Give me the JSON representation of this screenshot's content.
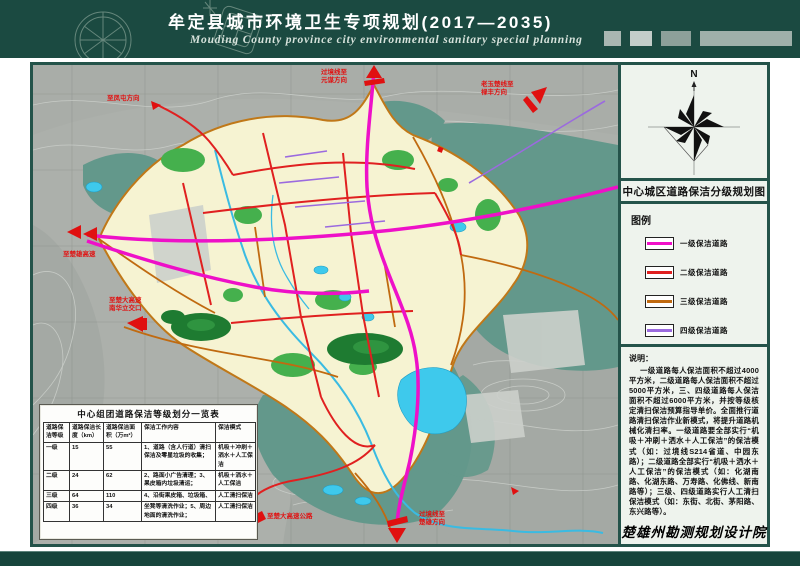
{
  "header": {
    "title": "牟定县城市环境卫生专项规划(2017—2035)",
    "subtitle": "Mouding County province city environmental sanitary special planning"
  },
  "panel": {
    "compass_label": "N",
    "map_title": "中心城区道路保洁分级规划图",
    "legend_title": "图例",
    "legend_items": [
      {
        "label": "一级保洁道路",
        "color": "#f010c8"
      },
      {
        "label": "二级保洁道路",
        "color": "#e02020"
      },
      {
        "label": "三级保洁道路",
        "color": "#c06a10"
      },
      {
        "label": "四级保洁道路",
        "color": "#9b6adf"
      }
    ],
    "notes_title": "说明：",
    "notes_body": "一级道路每人保洁面积不超过4000平方米，二级道路每人保洁面积不超过5000平方米，三、四级道路每人保洁面积不超过6000平方米，并按等级核定清扫保洁预算指导单价。全面推行道路清扫保洁作业新模式，将提升道路机械化清扫率。一级道路要全部实行“机吸＋冲刷＋洒水＋人工保洁”的保洁模式（如：过境线S214省道、中园东路）；二级道路全部实行“机吸＋洒水＋人工保洁”的保洁模式（如：化湖南路、化湖东路、万寿路、化佛线、新南路等）；三级、四级道路实行人工清扫保洁模式（如：东街、北街、茅阳路、东兴路等）。",
    "institute": "楚雄州勘测规划设计院"
  },
  "table": {
    "title": "中心组团道路保洁等级划分一览表",
    "headers": [
      "道路保洁等级",
      "道路保洁长度（km）",
      "道路保洁面积（万m²）",
      "保洁工作内容",
      "保洁模式"
    ],
    "rows": [
      [
        "一级",
        "15",
        "55",
        "1、道路（含人行道）清扫保洁及零星垃圾的收集；",
        "机吸＋冲刷＋洒水＋人工保洁"
      ],
      [
        "二级",
        "24",
        "62",
        "2、路面小广告清理；3、果皮箱内垃圾清运；",
        "机吸＋洒水＋人工保洁"
      ],
      [
        "三级",
        "64",
        "110",
        "4、沿街果皮箱、垃圾箱、",
        "人工清扫保洁"
      ],
      [
        "四级",
        "36",
        "34",
        "坐凳等清洗作业；5、周边地面的清洗作业；",
        "人工清扫保洁"
      ]
    ]
  },
  "map": {
    "labels": [
      {
        "text": "至凤屯方向"
      },
      {
        "text": "过境线至\n元谋方向"
      },
      {
        "text": "老玉楚线至\n禄丰方向"
      },
      {
        "text": "至楚雄高速"
      },
      {
        "text": "至楚大高速\n南华立交口"
      },
      {
        "text": "至楚大高速公路"
      },
      {
        "text": "过境线至\n楚雄方向"
      }
    ]
  }
}
